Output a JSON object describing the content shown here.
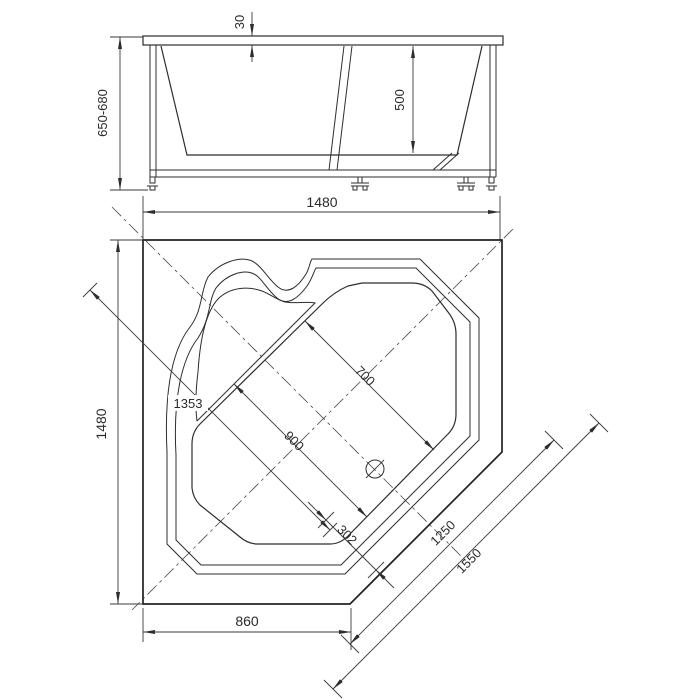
{
  "drawing": {
    "title": "corner-bathtub-technical-drawing",
    "colors": {
      "line": "#2d2d2d",
      "background": "#ffffff"
    },
    "front_view": {
      "dim_rim_thickness": "30",
      "dim_inner_depth": "500",
      "dim_height": "650-680",
      "dim_width": "1480"
    },
    "plan_view": {
      "dim_side": "1480",
      "dim_diagonal_depth": "1353",
      "dim_bowl_upper": "700",
      "dim_bowl_lower": "900",
      "dim_drain_offset": "302",
      "dim_front_inner": "1250",
      "dim_front_outer": "1550",
      "dim_bottom_edge": "860"
    }
  }
}
